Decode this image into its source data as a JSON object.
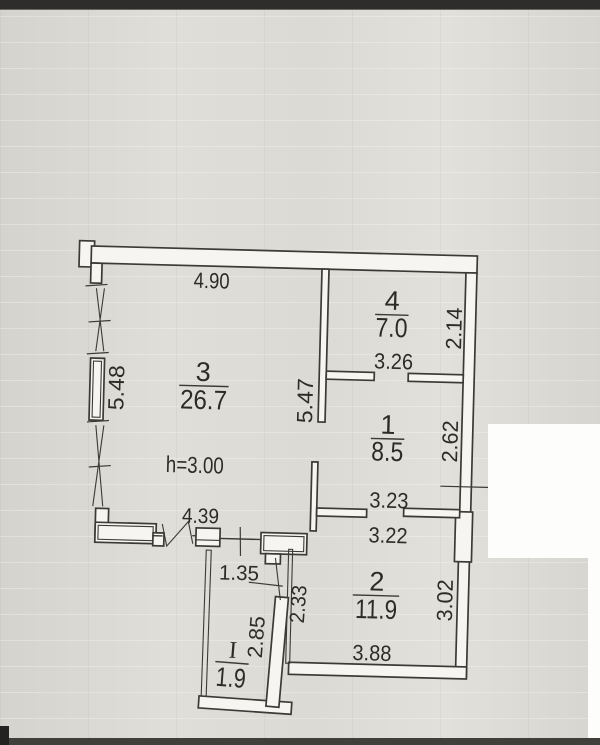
{
  "plan": {
    "ceiling_height": "h=3.00",
    "rooms": [
      {
        "number": "3",
        "area": "26.7"
      },
      {
        "number": "4",
        "area": "7.0"
      },
      {
        "number": "1",
        "area": "8.5"
      },
      {
        "number": "2",
        "area": "11.9"
      },
      {
        "number": "I",
        "area": "1.9"
      }
    ],
    "dimensions": {
      "top_width": "4.90",
      "left_height": "5.48",
      "room3_inner_height": "5.47",
      "room3_bottom_width": "4.39",
      "room4_width": "3.26",
      "room4_height": "2.14",
      "room1_width": "3.23",
      "room1_height": "2.62",
      "room2_upper_width": "3.22",
      "room2_height": "3.02",
      "room2_bottom_width": "3.88",
      "balcony_top_width": "1.35",
      "balcony_inner_height": "2.85",
      "balcony_right_height": "2.33"
    },
    "colors": {
      "line": "#3b3a36",
      "paper": "#dbd9d3",
      "wall_fill": "#f6f5f1",
      "patch": "#fdfdfb"
    }
  }
}
